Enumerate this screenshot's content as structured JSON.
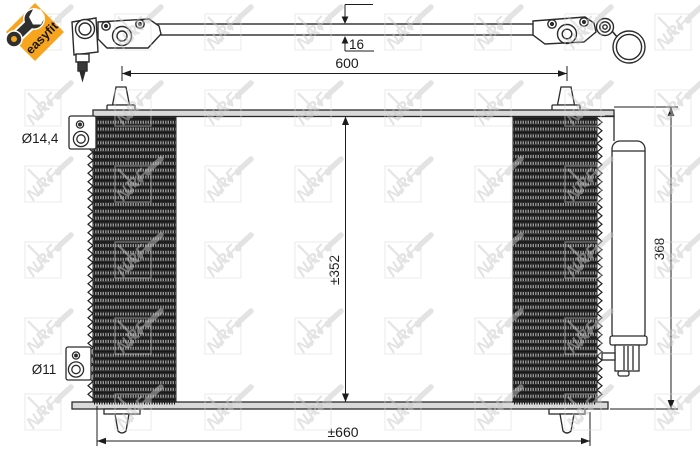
{
  "badge": {
    "label": "easyfit"
  },
  "watermark": {
    "brand": "NRF"
  },
  "top_view": {
    "dim_thickness": "16",
    "dim_pin_spacing": "600"
  },
  "front_view": {
    "dim_core_height": "±352",
    "dim_total_height": "368",
    "dim_total_width": "±660",
    "label_top_fitting": "Ø14,4",
    "label_bottom_fitting": "Ø11"
  }
}
